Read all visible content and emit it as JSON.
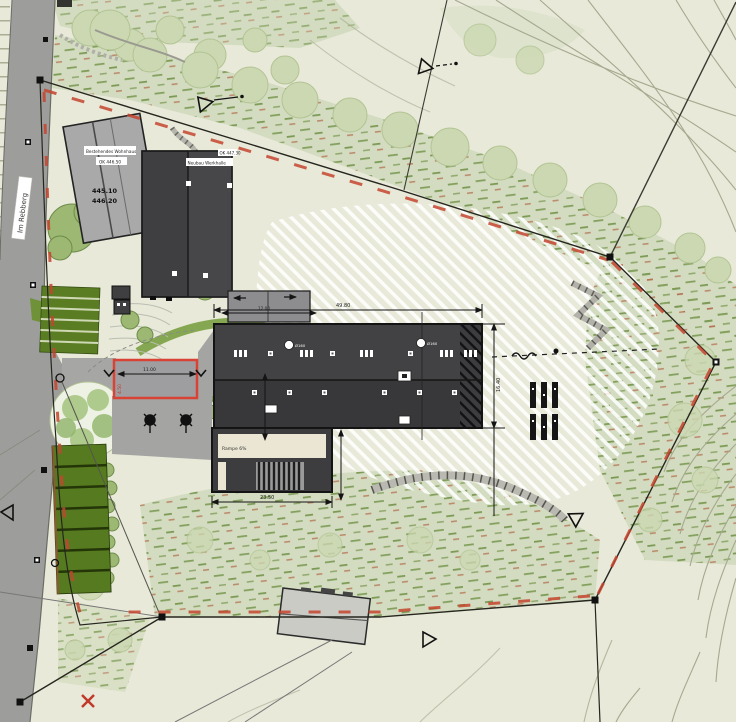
{
  "meta": {
    "type": "architectural-site-plan",
    "canvas_width": 736,
    "canvas_height": 722
  },
  "palette": {
    "background": "#e8e9d9",
    "vegetation": "#d3dcc0",
    "vegetation_light": "#dde3cc",
    "tuft_green": "#84a05e",
    "tuft_red": "#b26a4c",
    "contour": "#a6a98f",
    "road": "#9d9d9b",
    "road_edge": "#6c6c66",
    "building_dark": "#3d3d3f",
    "building_dark2": "#47474a",
    "building_light": "#a9a9a9",
    "building_mid": "#8d8d8f",
    "green_parking": "#567a20",
    "boundary_red": "#c4452f",
    "line_black": "#20201c",
    "cream": "#eae6d3",
    "wall_gray": "#9a9a92",
    "tree_fill": "#ccd8b2",
    "tree_stroke": "#b2c493",
    "highlight_red": "#d84335"
  },
  "labels": {
    "street_name": "Im Rebberg",
    "existing_building_line1": "Bestehendes Wohnhaus",
    "existing_building_line2": "OK 446.50",
    "existing_building_elev1": "445.10",
    "existing_building_elev2": "446.20",
    "new_building_line1": "Neubau Werkhalle",
    "new_building_line2": "OK 447.30",
    "vent_label_1": "Ø160",
    "vent_label_2": "Ø160",
    "ramp_label": "Rampe 6%",
    "red_area_label": "4.50",
    "dim_main_width": "49.80",
    "dim_main_depth": "16.40",
    "dim_ramp_width": "23.50",
    "dim_forecourt": "11.00",
    "dim_annex": "12.00"
  },
  "legend_symbols": {
    "boundary_marker": "black-square",
    "survey_triangle": "open-triangle",
    "boundary_line": "red-dashed-over-black",
    "tree_symbol": "circle-canopy",
    "boundary_cross": "red-x-mark"
  }
}
